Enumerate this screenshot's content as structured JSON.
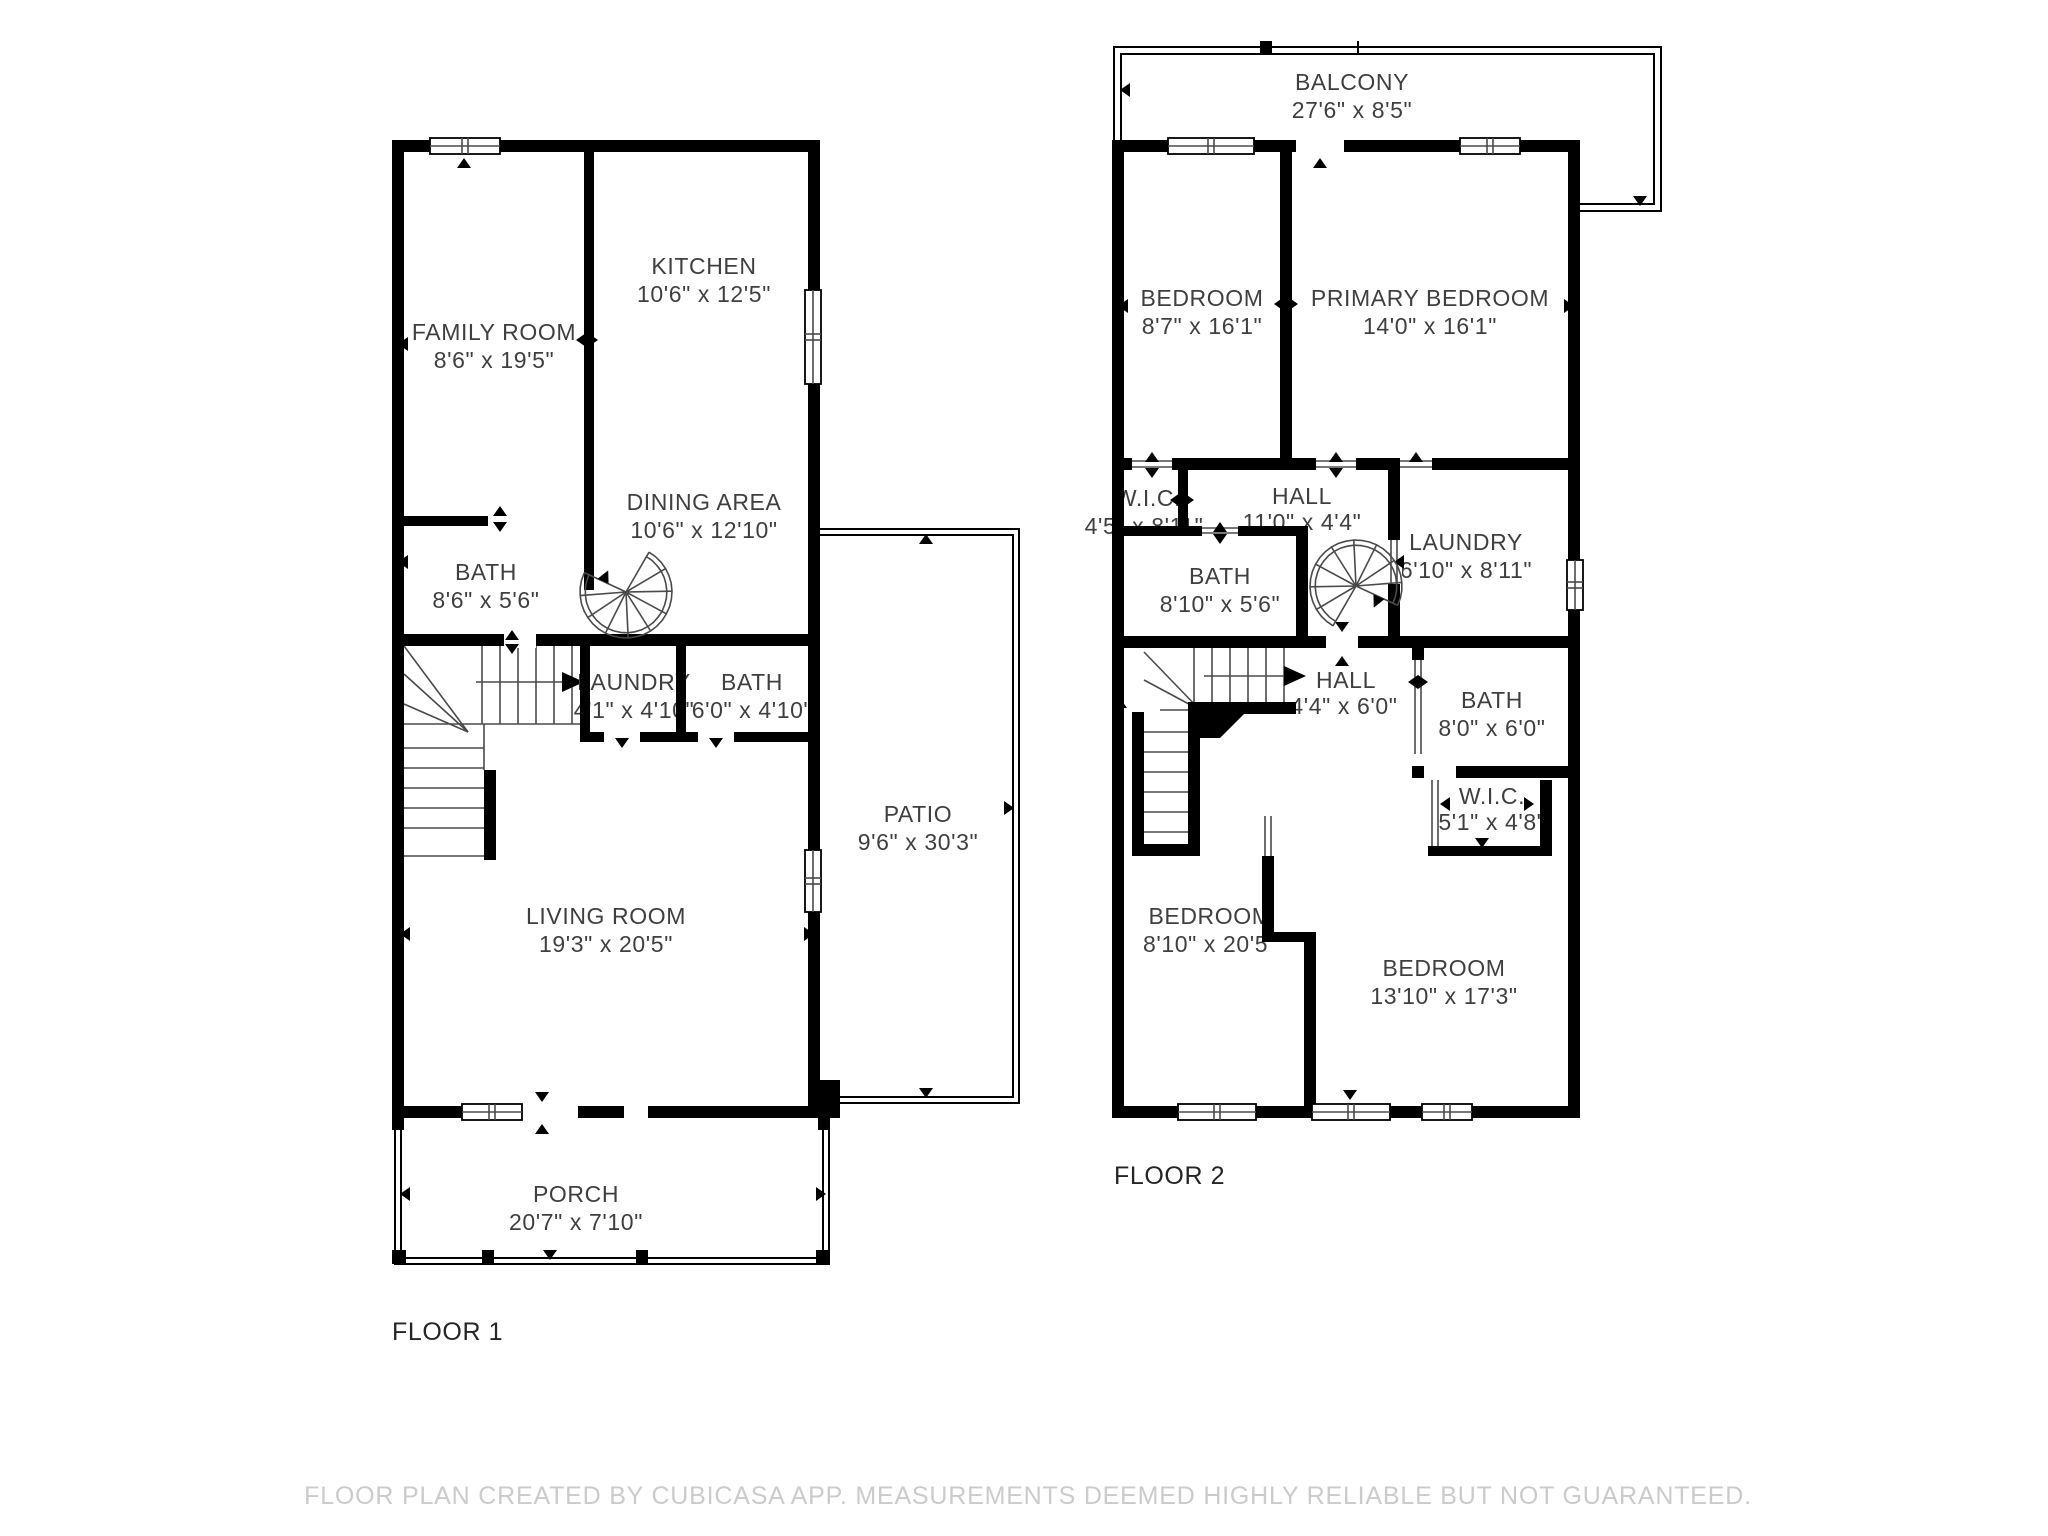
{
  "page": {
    "background": "#ffffff",
    "wall_color": "#000000",
    "label_color": "#3f3f3f",
    "disclaimer_color": "#cbcbcb"
  },
  "floor1": {
    "label": "FLOOR 1",
    "rooms": [
      {
        "name": "KITCHEN",
        "dims": "10'6\" x 12'5\""
      },
      {
        "name": "FAMILY ROOM",
        "dims": "8'6\" x 19'5\""
      },
      {
        "name": "DINING AREA",
        "dims": "10'6\" x 12'10\""
      },
      {
        "name": "BATH",
        "dims": "8'6\" x 5'6\""
      },
      {
        "name": "LAUNDRY",
        "dims": "4'1\" x 4'10\""
      },
      {
        "name": "BATH",
        "dims": "6'0\" x 4'10\""
      },
      {
        "name": "LIVING ROOM",
        "dims": "19'3\" x 20'5\""
      },
      {
        "name": "PATIO",
        "dims": "9'6\" x 30'3\""
      },
      {
        "name": "PORCH",
        "dims": "20'7\" x 7'10\""
      }
    ]
  },
  "floor2": {
    "label": "FLOOR 2",
    "rooms": [
      {
        "name": "BALCONY",
        "dims": "27'6\" x 8'5\""
      },
      {
        "name": "BEDROOM",
        "dims": "8'7\" x 16'1\""
      },
      {
        "name": "PRIMARY BEDROOM",
        "dims": "14'0\" x 16'1\""
      },
      {
        "name": "W.I.C.",
        "dims": "4'5\" x 8'11\""
      },
      {
        "name": "HALL",
        "dims": "11'0\" x 4'4\""
      },
      {
        "name": "LAUNDRY",
        "dims": "6'10\" x 8'11\""
      },
      {
        "name": "BATH",
        "dims": "8'10\" x 5'6\""
      },
      {
        "name": "HALL",
        "dims": "4'4\" x 6'0\""
      },
      {
        "name": "BATH",
        "dims": "8'0\" x 6'0\""
      },
      {
        "name": "W.I.C.",
        "dims": "5'1\" x 4'8\""
      },
      {
        "name": "BEDROOM",
        "dims": "8'10\" x 20'5\""
      },
      {
        "name": "BEDROOM",
        "dims": "13'10\" x 17'3\""
      }
    ]
  },
  "footer": {
    "disclaimer": "FLOOR PLAN CREATED BY CUBICASA APP. MEASUREMENTS DEEMED HIGHLY RELIABLE BUT NOT GUARANTEED."
  }
}
